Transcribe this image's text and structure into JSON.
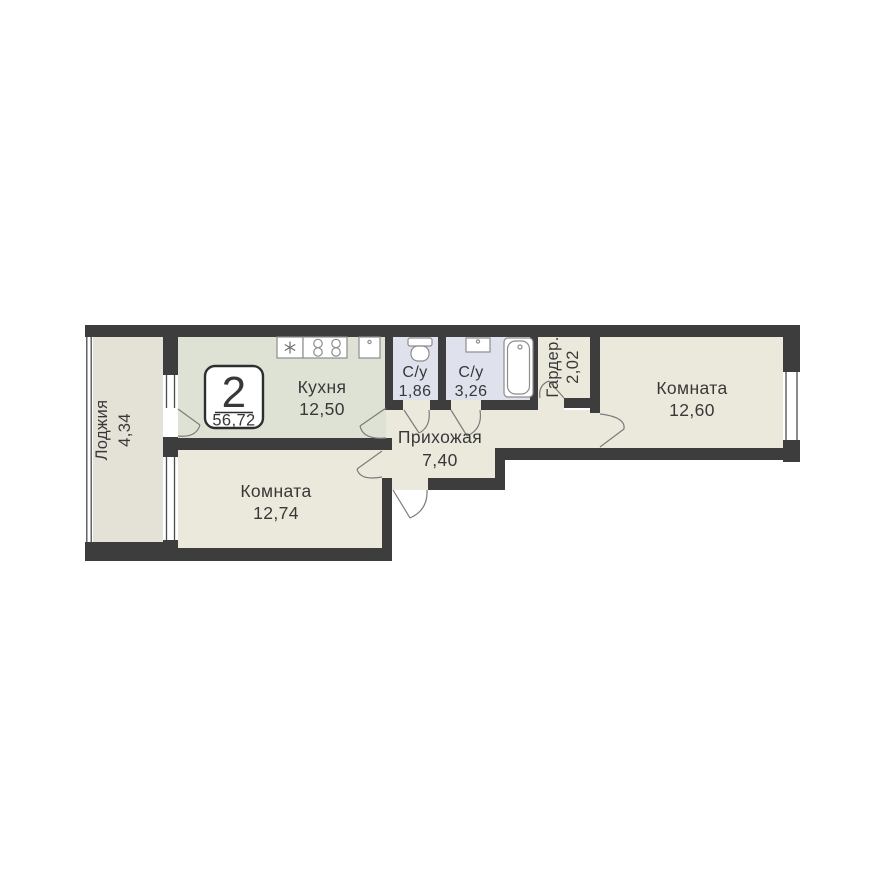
{
  "plan": {
    "badge": {
      "rooms_count": "2",
      "total_area": "56,72"
    },
    "rooms": [
      {
        "id": "loggia",
        "label": "Лоджия",
        "area": "4,34"
      },
      {
        "id": "kitchen",
        "label": "Кухня",
        "area": "12,50"
      },
      {
        "id": "bathroom_small",
        "label": "С/у",
        "area": "1,86"
      },
      {
        "id": "bathroom_large",
        "label": "С/у",
        "area": "3,26"
      },
      {
        "id": "wardrobe",
        "label": "Гардер.",
        "area": "2,02"
      },
      {
        "id": "room_right",
        "label": "Комната",
        "area": "12,60"
      },
      {
        "id": "hallway",
        "label": "Прихожая",
        "area": "7,40"
      },
      {
        "id": "room_bottom",
        "label": "Комната",
        "area": "12,74"
      }
    ],
    "icons": [
      "snowflake-sink-icon",
      "stove-burners-icon",
      "appliance-icon",
      "toilet-icon",
      "washbasin-icon",
      "bathtub-icon",
      "door-swing-icon",
      "window-glazing"
    ],
    "colors": {
      "wall": "#3d3d3d",
      "room_fill": "#ebe8dc",
      "loggia_fill": "#e4e1d6",
      "kitchen_fill": "#dee2d5",
      "bathroom_fill": "#dfe2ed",
      "background": "#ffffff"
    }
  }
}
